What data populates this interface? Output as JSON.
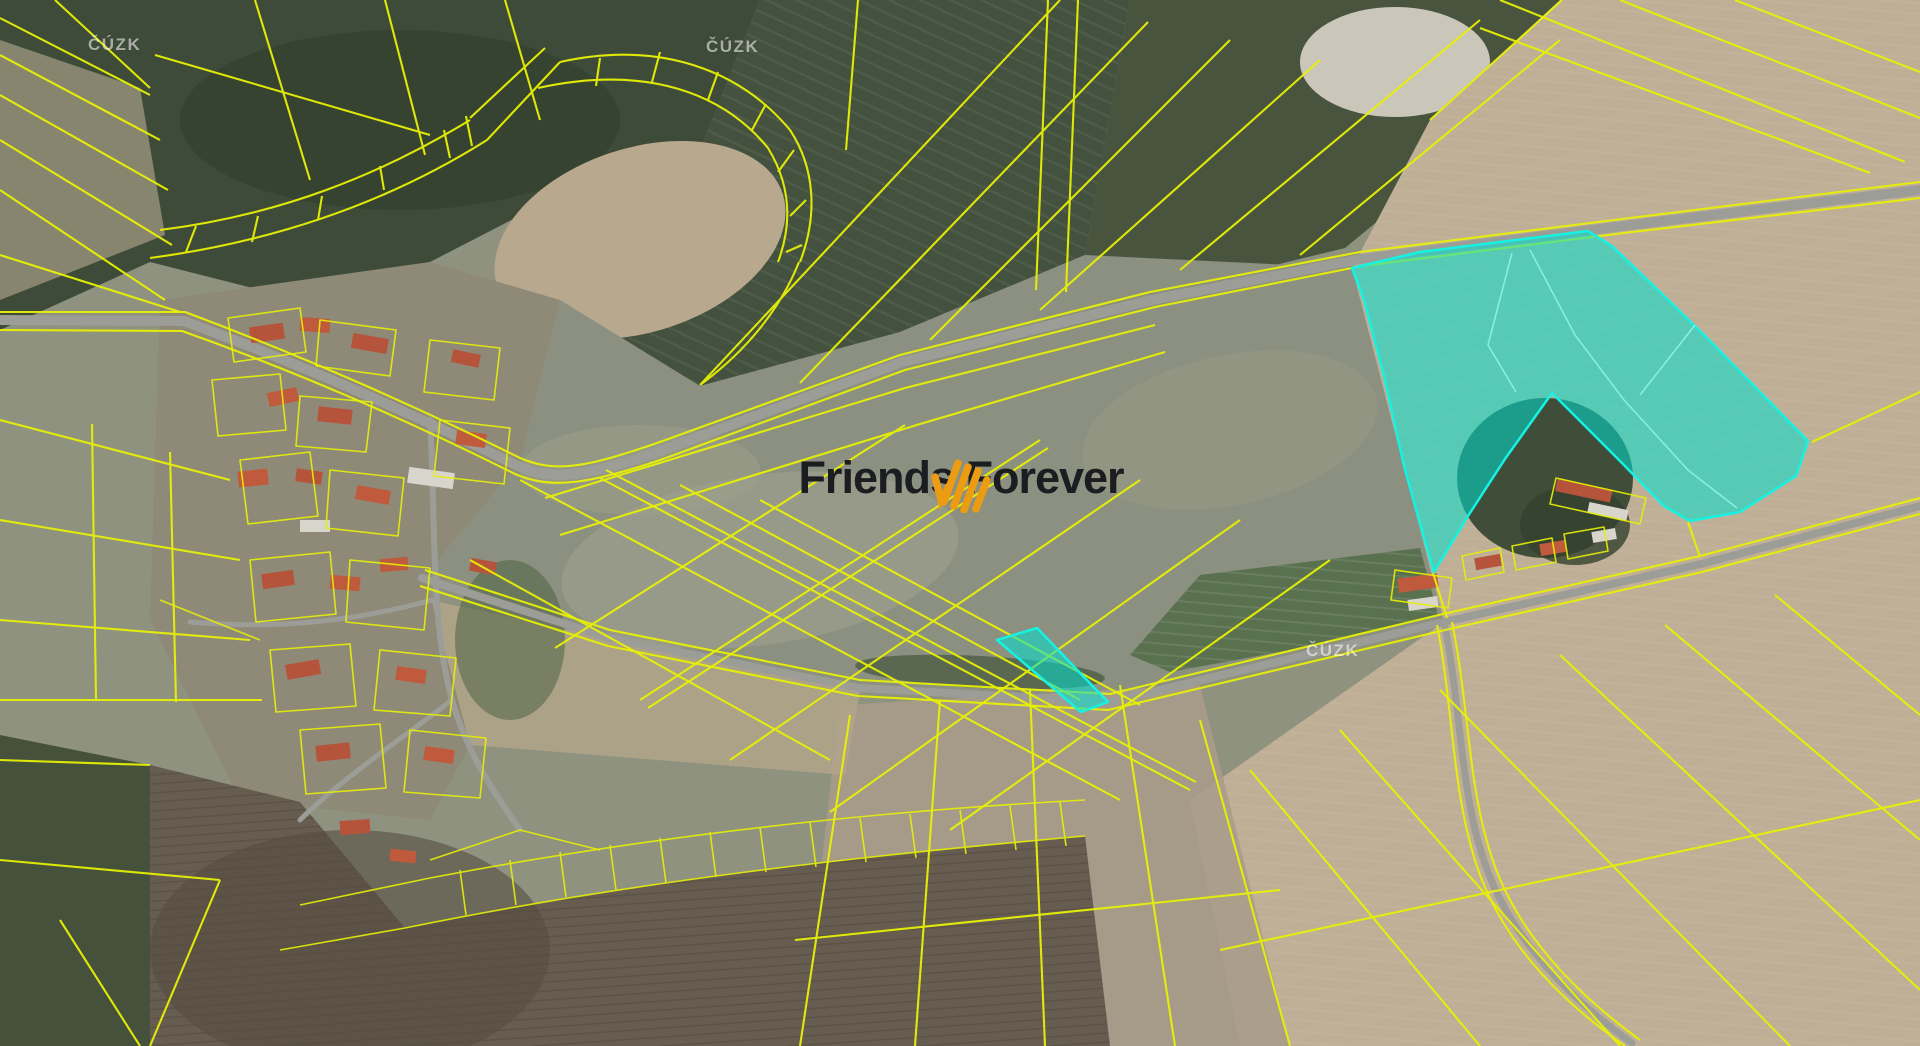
{
  "map": {
    "description": "Aerial cadastral map (satellite photo) with yellow parcel boundary overlay, two parcels highlighted in cyan, village at left, fields and forest",
    "provider": "ČÚZK",
    "watermarks": [
      {
        "label": "ČÚZK",
        "x": 88,
        "y": 36
      },
      {
        "label": "ČÚZK",
        "x": 706,
        "y": 38
      },
      {
        "label": "ČÚZK",
        "x": 1306,
        "y": 642
      }
    ],
    "brand": {
      "name": "Friends Forever",
      "logo_icon": "orange-hatch-strokes-logo"
    },
    "highlighted_parcels": [
      {
        "id": "large-parcel-northeast",
        "shape": "arrow-like polygon with triangular notch at bottom",
        "color": "cyan"
      },
      {
        "id": "small-strip-parcel-center",
        "shape": "narrow parallelogram beside road",
        "color": "cyan"
      }
    ],
    "colors": {
      "parcel_line": "#e7f005",
      "highlight_fill": "#00e0d0",
      "highlight_stroke": "#16f2e2",
      "highlight_inner_line": "#8ff5ea",
      "road": "#9d9d98",
      "brand_orange": "#ec9c12",
      "brand_text": "#1b1d21",
      "watermark": "#ffffff",
      "field_green_dark": "#41503d",
      "field_green_gray": "#8b9080",
      "field_tan": "#bfaf96",
      "forest_brown": "#665c4f",
      "roof_red": "#b5543a"
    }
  }
}
